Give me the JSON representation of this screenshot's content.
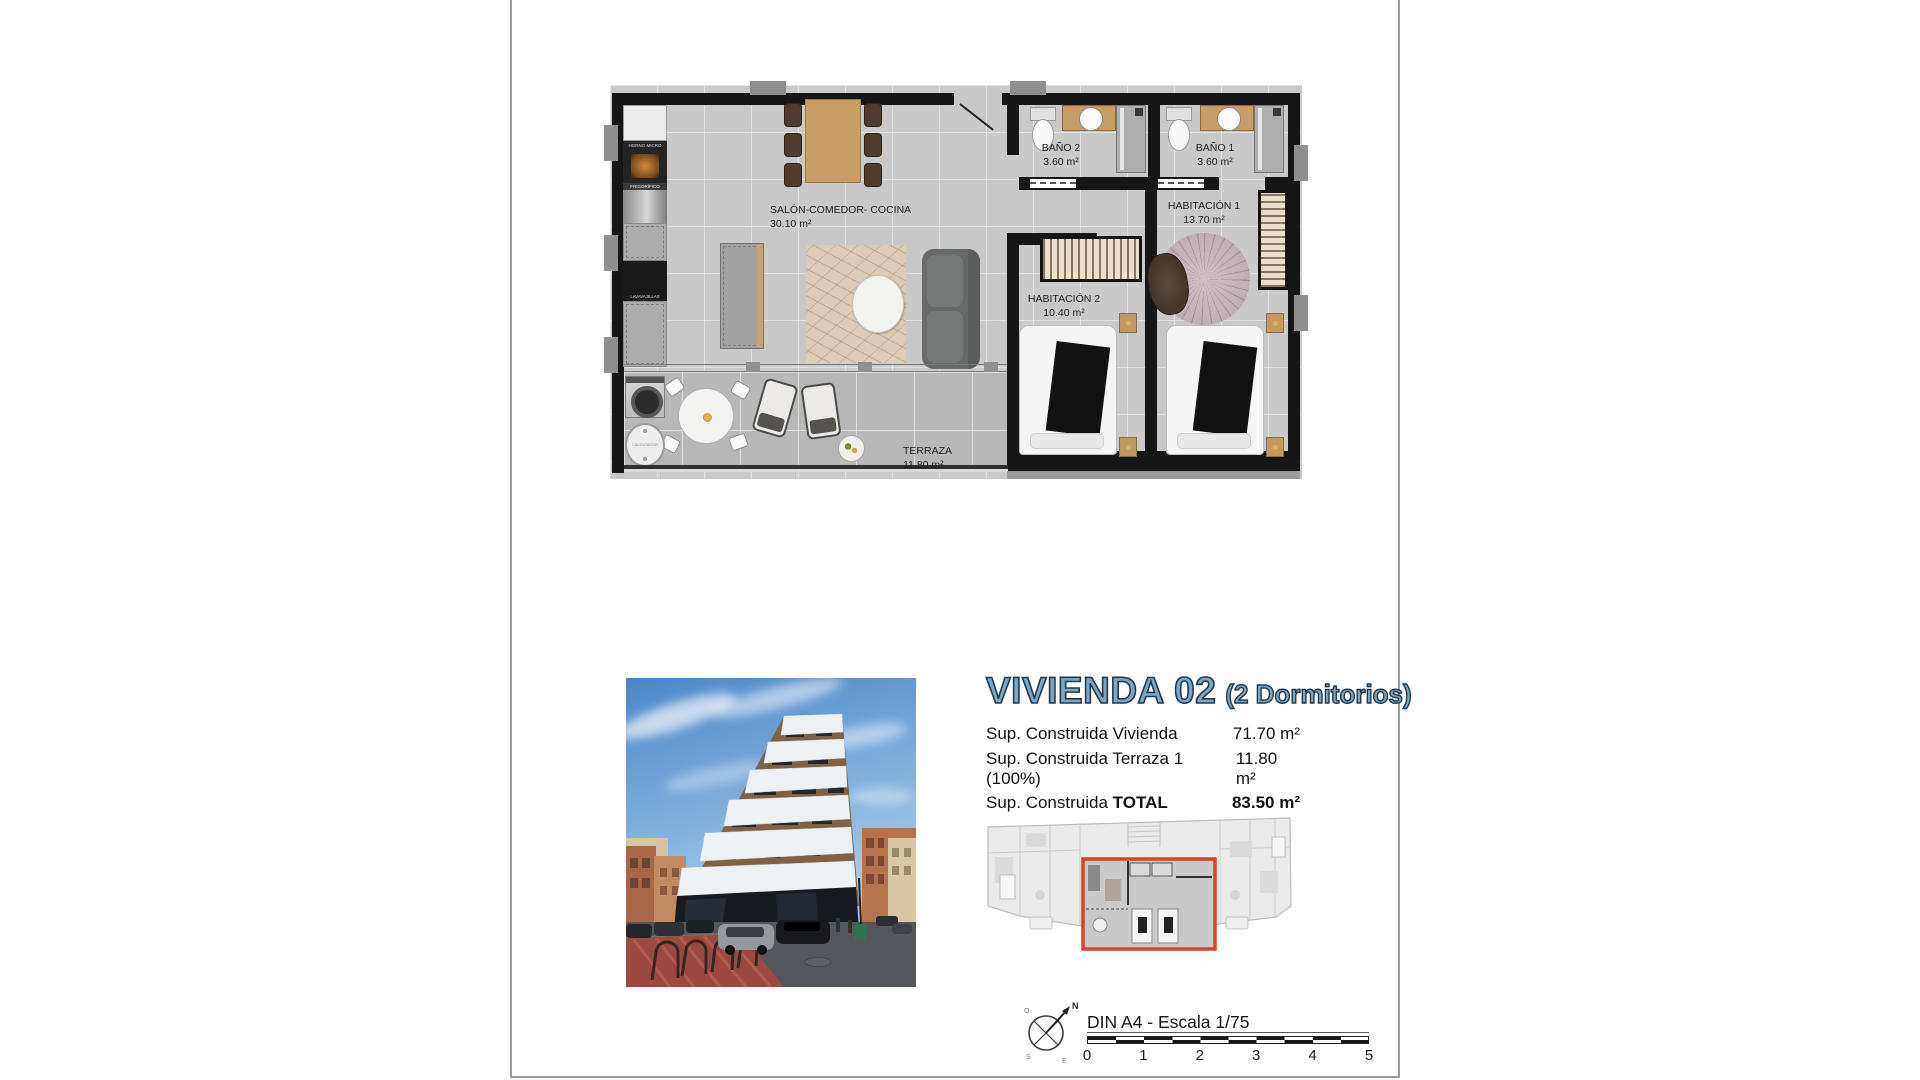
{
  "colors": {
    "accent_red": "#d8422c",
    "title_fill": "#7ea6c0",
    "title_stroke": "#1c3a52"
  },
  "floor_plan": {
    "rooms": [
      {
        "name": "SALÓN-COMEDOR- COCINA",
        "area": "30.10 m²"
      },
      {
        "name": "BAÑO 2",
        "area": "3.60 m²"
      },
      {
        "name": "BAÑO 1",
        "area": "3.60 m²"
      },
      {
        "name": "HABITACIÓN 1",
        "area": "13.70 m²"
      },
      {
        "name": "HABITACIÓN 2",
        "area": "10.40 m²"
      },
      {
        "name": "TERRAZA",
        "area": "11.80 m²"
      }
    ],
    "appliances": {
      "oven": "HORNO MICRO",
      "fridge": "FRIGORÍFICO",
      "dishwasher": "LAVAVAJILLAS",
      "heater": "CALENTADOR"
    }
  },
  "details": {
    "title": "VIVIENDA 02",
    "subtitle": "(2 Dormitorios)",
    "surfaces": [
      {
        "label": "Sup. Construida Vivienda",
        "label_bold": "",
        "value": "71.70 m²"
      },
      {
        "label": "Sup. Construida Terraza 1 (100%)",
        "label_bold": "",
        "value": "11.80 m²"
      },
      {
        "label": "Sup. Construida ",
        "label_bold": "TOTAL",
        "value": "83.50 m²"
      }
    ]
  },
  "footer": {
    "scale_label": "DIN A4 - Escala 1/75",
    "ticks": [
      "0",
      "1",
      "2",
      "3",
      "4",
      "5"
    ],
    "compass": {
      "n": "N",
      "s": "S",
      "e": "E",
      "w": "O"
    }
  }
}
